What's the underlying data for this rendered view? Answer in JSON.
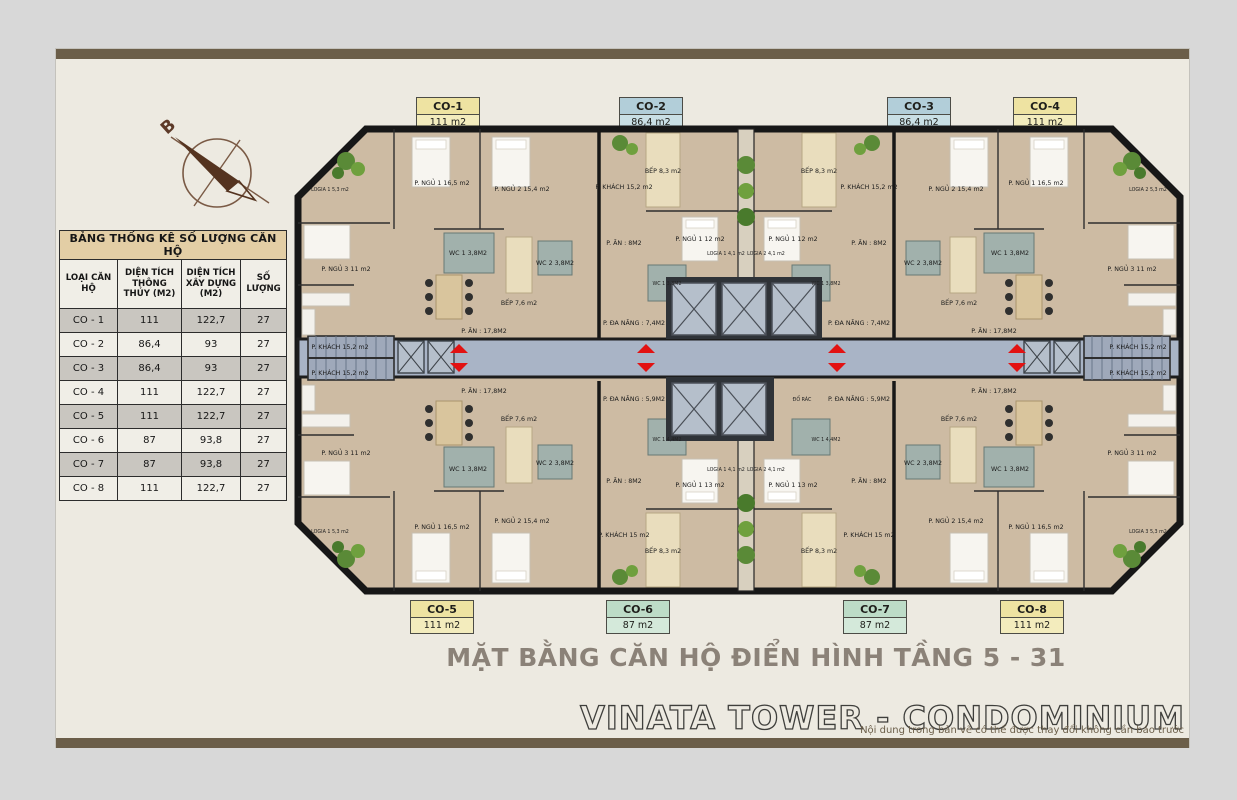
{
  "page": {
    "background": "#d8d8d8",
    "sheet_background": "#edeae1",
    "frame_bar_color": "#6b5e49"
  },
  "compass": {
    "north_label": "B"
  },
  "stats_table": {
    "title": "BẢNG THỐNG KÊ SỐ LƯỢNG CĂN HỘ",
    "columns": [
      "LOẠI CĂN HỘ",
      "DIỆN TÍCH THÔNG THỦY (M2)",
      "DIỆN TÍCH XÂY DỰNG (M2)",
      "SỐ LƯỢNG"
    ],
    "rows": [
      {
        "type": "CO - 1",
        "net": "111",
        "gross": "122,7",
        "count": "27"
      },
      {
        "type": "CO - 2",
        "net": "86,4",
        "gross": "93",
        "count": "27"
      },
      {
        "type": "CO - 3",
        "net": "86,4",
        "gross": "93",
        "count": "27"
      },
      {
        "type": "CO - 4",
        "net": "111",
        "gross": "122,7",
        "count": "27"
      },
      {
        "type": "CO - 5",
        "net": "111",
        "gross": "122,7",
        "count": "27"
      },
      {
        "type": "CO - 6",
        "net": "87",
        "gross": "93,8",
        "count": "27"
      },
      {
        "type": "CO - 7",
        "net": "87",
        "gross": "93,8",
        "count": "27"
      },
      {
        "type": "CO - 8",
        "net": "111",
        "gross": "122,7",
        "count": "27"
      }
    ]
  },
  "plan": {
    "title": "MẶT BẰNG CĂN HỘ ĐIỂN HÌNH TẦNG 5 - 31",
    "colors": {
      "floor_wood": "#cdbba3",
      "corridor": "#a9b4c6",
      "wall": "#171717",
      "arrow_red": "#e21212",
      "plant_green": "#5a8a37",
      "kitchen_tile": "#e9ddbd"
    },
    "top_labels": [
      {
        "name": "CO-1",
        "area": "111 m2",
        "css": "chip yellow"
      },
      {
        "name": "CO-2",
        "area": "86,4 m2",
        "css": "chip blue"
      },
      {
        "name": "CO-3",
        "area": "86,4 m2",
        "css": "chip blue"
      },
      {
        "name": "CO-4",
        "area": "111 m2",
        "css": "chip yellow"
      }
    ],
    "bottom_labels": [
      {
        "name": "CO-5",
        "area": "111 m2",
        "css": "chip yellow"
      },
      {
        "name": "CO-6",
        "area": "87 m2",
        "css": "chip green"
      },
      {
        "name": "CO-7",
        "area": "87 m2",
        "css": "chip green"
      },
      {
        "name": "CO-8",
        "area": "111 m2",
        "css": "chip yellow"
      }
    ],
    "core": {
      "trash_label": "ĐỔ RÁC"
    },
    "units": [
      {
        "id": "CO-1",
        "rooms": [
          "P. NGỦ 1 16,5 m2",
          "P. NGỦ 2 15,4 m2",
          "P. NGỦ 3 11 m2",
          "P. KHÁCH 15,2 m2",
          "P. ĂN : 17,8M2",
          "BẾP 7,6 m2",
          "WC 1 3,8M2",
          "WC 2 3,8M2",
          "LOGIA 1 5,3 m2"
        ]
      },
      {
        "id": "CO-2",
        "rooms": [
          "P. KHÁCH 15,2 m2",
          "BẾP 8,3 m2",
          "LOGIA 1 4,1 m2",
          "P. ĂN : 8M2",
          "P. NGỦ 1 12 m2",
          "WC 1 3,8M2",
          "P. ĐA NĂNG : 7,4M2"
        ]
      },
      {
        "id": "CO-3",
        "rooms": [
          "P. KHÁCH 15,2 m2",
          "BẾP 8,3 m2",
          "LOGIA 2 4,1 m2",
          "P. ĂN : 8M2",
          "P. NGỦ 1 12 m2",
          "WC 1 3,8M2",
          "P. ĐA NĂNG : 7,4M2"
        ]
      },
      {
        "id": "CO-4",
        "rooms": [
          "P. NGỦ 1 16,5 m2",
          "P. NGỦ 2 15,4 m2",
          "P. NGỦ 3 11 m2",
          "P. KHÁCH 15,2 m2",
          "P. ĂN : 17,8M2",
          "BẾP 7,6 m2",
          "WC 1 3,8M2",
          "WC 2 3,8M2",
          "LOGIA 2 5,3 m2"
        ]
      },
      {
        "id": "CO-5",
        "rooms": [
          "P. NGỦ 1 16,5 m2",
          "P. NGỦ 2 15,4 m2",
          "P. NGỦ 3 11 m2",
          "P. KHÁCH 15,2 m2",
          "P. ĂN : 17,8M2",
          "BẾP 7,6 m2",
          "WC 1 3,8M2",
          "WC 2 3,8M2",
          "LOGIA 1 5,3 m2"
        ]
      },
      {
        "id": "CO-6",
        "rooms": [
          "P. KHÁCH 15 m2",
          "BẾP 8,3 m2",
          "LOGIA 1 4,1 m2",
          "P. ĂN : 8M2",
          "P. NGỦ 1 13 m2",
          "WC 1 4,4M2",
          "P. ĐA NĂNG : 5,9M2"
        ]
      },
      {
        "id": "CO-7",
        "rooms": [
          "P. KHÁCH 15 m2",
          "BẾP 8,3 m2",
          "LOGIA 2 4,1 m2",
          "P. ĂN : 8M2",
          "P. NGỦ 1 13 m2",
          "WC 1 4,4M2",
          "P. ĐA NĂNG : 5,9M2"
        ]
      },
      {
        "id": "CO-8",
        "rooms": [
          "P. NGỦ 1 16,5 m2",
          "P. NGỦ 2 15,4 m2",
          "P. NGỦ 3 11 m2",
          "P. KHÁCH 15,2 m2",
          "P. ĂN : 17,8M2",
          "BẾP 7,6 m2",
          "WC 1 3,8M2",
          "WC 2 3,8M2",
          "LOGIA 3 5,3 m2"
        ]
      }
    ]
  },
  "footer": {
    "brand": "VINATA TOWER - CONDOMINIUM",
    "disclaimer": "Nội dung trong bản vẽ có thể được thay đổi không cần báo trước"
  }
}
